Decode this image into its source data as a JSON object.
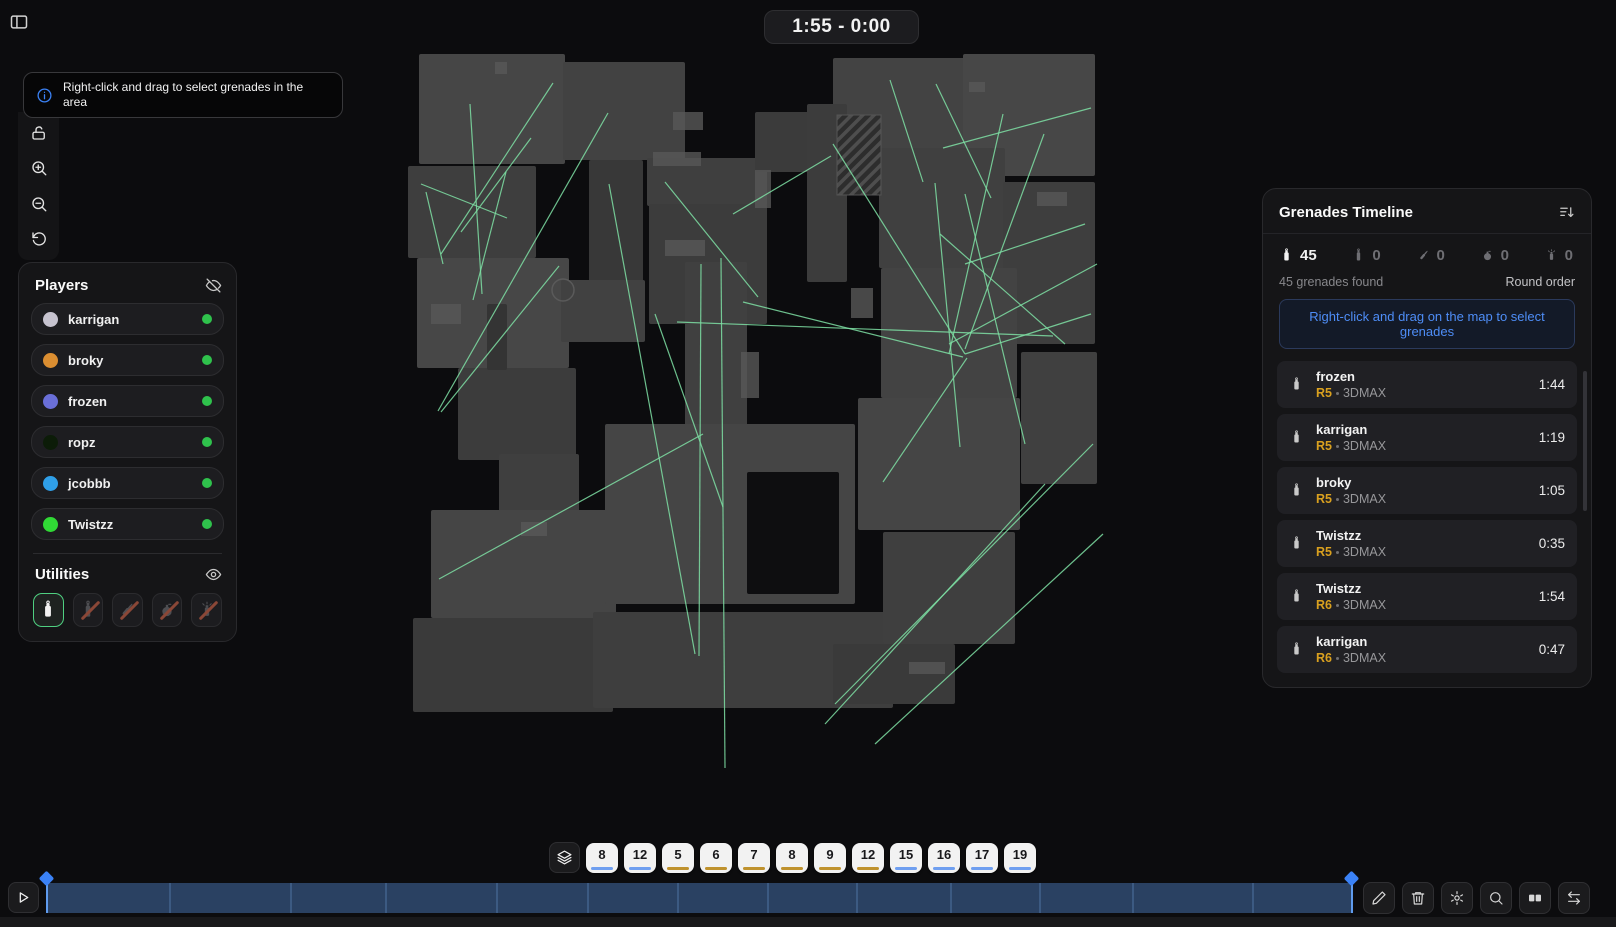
{
  "top": {
    "timer": "1:55 - 0:00"
  },
  "tooltip": {
    "text": "Right-click and drag to select grenades in the area",
    "icon": "info"
  },
  "map_toolbar": {
    "icons": [
      "unlock",
      "zoom-in",
      "zoom-out",
      "reset"
    ]
  },
  "players_panel": {
    "title": "Players",
    "visibility_icon": "eye-off",
    "players": [
      {
        "name": "karrigan",
        "color": "#c6c3cf",
        "status_color": "#2fc24c"
      },
      {
        "name": "broky",
        "color": "#db8e31",
        "status_color": "#2fc24c"
      },
      {
        "name": "frozen",
        "color": "#6a6fd8",
        "status_color": "#2fc24c"
      },
      {
        "name": "ropz",
        "color": "#0c1c08",
        "status_color": "#2fc24c"
      },
      {
        "name": "jcobbb",
        "color": "#2f9fe8",
        "status_color": "#2fc24c"
      },
      {
        "name": "Twistzz",
        "color": "#30d935",
        "status_color": "#2fc24c"
      }
    ]
  },
  "utilities_panel": {
    "title": "Utilities",
    "visibility_icon": "eye",
    "items": [
      {
        "type": "smoke",
        "selected": true
      },
      {
        "type": "flashbang",
        "selected": false
      },
      {
        "type": "molotov",
        "selected": false
      },
      {
        "type": "he-grenade",
        "selected": false
      },
      {
        "type": "decoy",
        "selected": false
      }
    ]
  },
  "grenades_panel": {
    "title": "Grenades Timeline",
    "sort_icon": "sort-desc",
    "counts": [
      {
        "type": "smoke",
        "count": 45,
        "active": true
      },
      {
        "type": "flashbang",
        "count": 0,
        "active": false
      },
      {
        "type": "molotov",
        "count": 0,
        "active": false
      },
      {
        "type": "he-grenade",
        "count": 0,
        "active": false
      },
      {
        "type": "decoy",
        "count": 0,
        "active": false
      }
    ],
    "summary": "45 grenades found",
    "order_label": "Round order",
    "hint": "Right-click and drag on the map to select grenades",
    "items": [
      {
        "player": "frozen",
        "round": "R5",
        "team": "3DMAX",
        "time": "1:44"
      },
      {
        "player": "karrigan",
        "round": "R5",
        "team": "3DMAX",
        "time": "1:19"
      },
      {
        "player": "broky",
        "round": "R5",
        "team": "3DMAX",
        "time": "1:05"
      },
      {
        "player": "Twistzz",
        "round": "R5",
        "team": "3DMAX",
        "time": "0:35"
      },
      {
        "player": "Twistzz",
        "round": "R6",
        "team": "3DMAX",
        "time": "1:54"
      },
      {
        "player": "karrigan",
        "round": "R6",
        "team": "3DMAX",
        "time": "0:47"
      }
    ]
  },
  "rounds_bar": {
    "layers_icon": "layers",
    "ct_color": "#6f9ff0",
    "t_color": "#bf922e",
    "rounds": [
      {
        "number": "8",
        "color": "#6f9ff0"
      },
      {
        "number": "12",
        "color": "#6f9ff0"
      },
      {
        "number": "5",
        "color": "#bf922e"
      },
      {
        "number": "6",
        "color": "#bf922e"
      },
      {
        "number": "7",
        "color": "#bf922e"
      },
      {
        "number": "8",
        "color": "#bf922e"
      },
      {
        "number": "9",
        "color": "#bf922e"
      },
      {
        "number": "12",
        "color": "#bf922e"
      },
      {
        "number": "15",
        "color": "#6f9ff0"
      },
      {
        "number": "16",
        "color": "#6f9ff0"
      },
      {
        "number": "17",
        "color": "#6f9ff0"
      },
      {
        "number": "19",
        "color": "#6f9ff0"
      }
    ]
  },
  "timeline": {
    "bar_color": "#2a4162",
    "marker_color": "#3b82f6",
    "dividers": [
      0.094,
      0.187,
      0.259,
      0.344,
      0.414,
      0.483,
      0.552,
      0.62,
      0.692,
      0.76,
      0.831,
      0.923
    ]
  },
  "bottom_toolbar": {
    "icons": [
      "edit",
      "delete",
      "settings",
      "search",
      "clips",
      "switch"
    ]
  },
  "map": {
    "line_color": "#7ee0a4",
    "blocks": [
      [
        16,
        2,
        146,
        110,
        "#464646"
      ],
      [
        5,
        114,
        128,
        92,
        "#3e3e3e"
      ],
      [
        14,
        206,
        152,
        110,
        "#474747"
      ],
      [
        55,
        316,
        118,
        92,
        "#3c3c3c"
      ],
      [
        84,
        252,
        20,
        66,
        "#343434"
      ],
      [
        96,
        402,
        80,
        60,
        "#3f3f3f"
      ],
      [
        28,
        458,
        185,
        108,
        "#454545"
      ],
      [
        10,
        566,
        200,
        94,
        "#3a3a3a"
      ],
      [
        160,
        10,
        122,
        98,
        "#424242"
      ],
      [
        186,
        108,
        54,
        122,
        "#383838"
      ],
      [
        158,
        228,
        84,
        62,
        "#414141"
      ],
      [
        244,
        106,
        120,
        48,
        "#3f3f3f"
      ],
      [
        246,
        152,
        118,
        120,
        "#3c3c3c"
      ],
      [
        282,
        210,
        62,
        332,
        "#404040"
      ],
      [
        352,
        60,
        80,
        60,
        "#3b3b3b"
      ],
      [
        202,
        372,
        250,
        180,
        "#454545"
      ],
      [
        344,
        420,
        92,
        122,
        "#0e0e10"
      ],
      [
        190,
        560,
        300,
        96,
        "#3e3e3e"
      ],
      [
        430,
        6,
        132,
        112,
        "#434343"
      ],
      [
        560,
        2,
        132,
        122,
        "#474747"
      ],
      [
        404,
        52,
        40,
        178,
        "#3c3c3c"
      ],
      [
        476,
        96,
        126,
        120,
        "#404040"
      ],
      [
        600,
        130,
        92,
        162,
        "#3e3e3e"
      ],
      [
        478,
        216,
        136,
        130,
        "#434343"
      ],
      [
        618,
        300,
        76,
        132,
        "#404040"
      ],
      [
        455,
        346,
        162,
        132,
        "#454545"
      ],
      [
        480,
        480,
        132,
        112,
        "#3f3f3f"
      ],
      [
        430,
        592,
        122,
        60,
        "#3a3a3a"
      ]
    ],
    "hatch_block": [
      434,
      63,
      44,
      80
    ],
    "details": [
      [
        250,
        100,
        48,
        14
      ],
      [
        92,
        10,
        12,
        12
      ],
      [
        262,
        188,
        40,
        16
      ],
      [
        28,
        252,
        30,
        20
      ],
      [
        352,
        118,
        16,
        38
      ],
      [
        566,
        30,
        16,
        10
      ],
      [
        634,
        140,
        30,
        14
      ],
      [
        118,
        470,
        26,
        14
      ],
      [
        506,
        610,
        36,
        12
      ],
      [
        270,
        60,
        30,
        18
      ],
      [
        448,
        236,
        22,
        30
      ],
      [
        338,
        300,
        18,
        46
      ]
    ],
    "lines": [
      [
        150,
        31,
        38,
        202
      ],
      [
        67,
        52,
        79,
        242
      ],
      [
        128,
        86,
        58,
        180
      ],
      [
        18,
        132,
        104,
        166
      ],
      [
        40,
        212,
        23,
        140
      ],
      [
        205,
        61,
        35,
        359
      ],
      [
        156,
        214,
        38,
        360
      ],
      [
        103,
        120,
        70,
        248
      ],
      [
        300,
        382,
        36,
        527
      ],
      [
        206,
        132,
        292,
        602
      ],
      [
        252,
        262,
        320,
        455
      ],
      [
        298,
        212,
        296,
        604
      ],
      [
        318,
        206,
        322,
        716
      ],
      [
        274,
        270,
        650,
        284
      ],
      [
        330,
        162,
        428,
        104
      ],
      [
        262,
        130,
        355,
        245
      ],
      [
        340,
        250,
        560,
        305
      ],
      [
        533,
        32,
        588,
        146
      ],
      [
        540,
        96,
        688,
        56
      ],
      [
        562,
        212,
        682,
        172
      ],
      [
        532,
        131,
        557,
        395
      ],
      [
        562,
        142,
        622,
        392
      ],
      [
        537,
        182,
        662,
        292
      ],
      [
        546,
        292,
        694,
        212
      ],
      [
        600,
        62,
        546,
        302
      ],
      [
        641,
        82,
        562,
        297
      ],
      [
        562,
        302,
        688,
        262
      ],
      [
        430,
        92,
        562,
        302
      ],
      [
        487,
        28,
        520,
        130
      ],
      [
        564,
        306,
        480,
        430
      ],
      [
        432,
        652,
        690,
        392
      ],
      [
        422,
        672,
        642,
        432
      ],
      [
        472,
        692,
        700,
        482
      ]
    ]
  }
}
